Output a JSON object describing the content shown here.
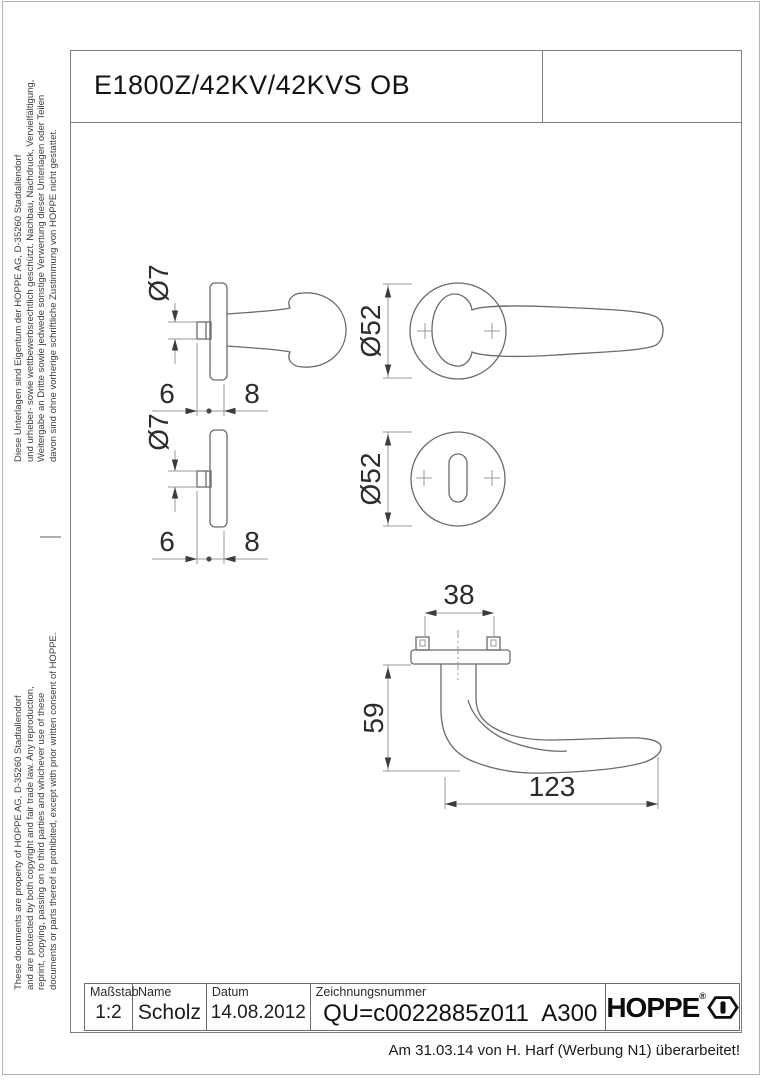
{
  "header": {
    "title": "E1800Z/42KV/42KVS OB"
  },
  "legal": {
    "german": "Diese Unterlagen sind Eigentum der HOPPE AG, D-35260 Stadtallendorf\nund urheber- sowie wettbewerbsrechtlich geschützt. Nachbau, Nachdruck, Vervielfältigung,\nWeitergabe an Dritte sowie jedwede sonstige Verwertung dieser Unterlagen oder Teilen\ndavon sind ohne vorherige schriftliche Zustimmung von HOPPE nicht gestattet.",
    "english": "These documents are property of HOPPE AG, D-35260 Stadtallendorf\nand are protected by both copyright and fair trade law. Any reproduction,\nreprint, copying, passing on to third parties and whichever use of these\ndocuments or parts thereof is prohibited, except with prior written consent of HOPPE."
  },
  "dimensions": {
    "spindle_diameter": "Ø7",
    "rose_diameter": "Ø52",
    "dim6": "6",
    "dim8": "8",
    "screw_distance": "38",
    "handle_depth": "59",
    "handle_length": "123"
  },
  "title_block": {
    "scale_label": "Maßstab",
    "scale_value": "1:2",
    "name_label": "Name",
    "name_value": "Scholz",
    "date_label": "Datum",
    "date_value": "14.08.2012",
    "drawing_number_label": "Zeichnungsnummer",
    "drawing_number_value": "QU=c0022885z011",
    "revision_code": "A300",
    "brand": "HOPPE"
  },
  "footer": {
    "revision_note": "Am 31.03.14 von H. Harf (Werbung N1) überarbeitet!"
  }
}
